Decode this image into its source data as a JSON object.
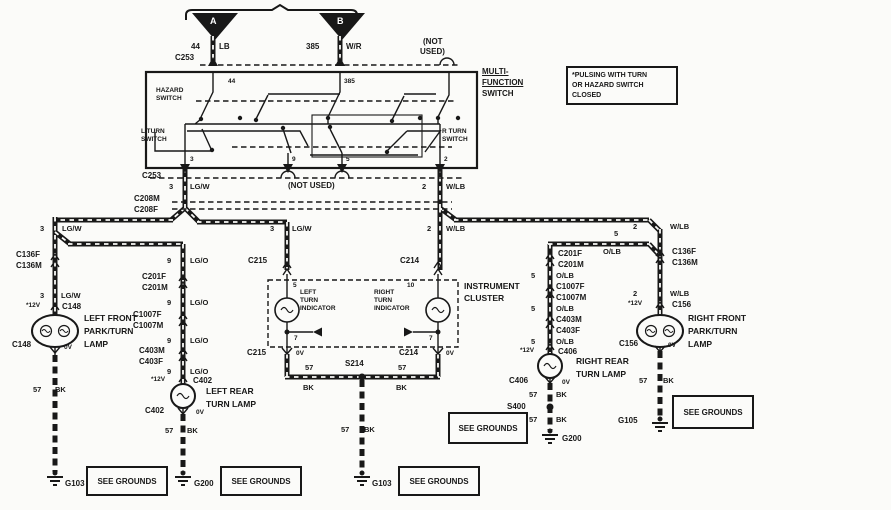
{
  "colors": {
    "ink": "#181818",
    "bg": "#fbfbf9"
  },
  "top": {
    "a": "A",
    "b": "B",
    "circuit_a": "44",
    "color_a": "LB",
    "circuit_b": "385",
    "color_b": "W/R",
    "not_used_1": "(NOT",
    "not_used_2": "USED)",
    "c253": "C253"
  },
  "note": {
    "l1": "*PULSING WITH TURN",
    "l2": "OR HAZARD SWITCH",
    "l3": "CLOSED"
  },
  "mfs": {
    "t1": "MULTI-",
    "t2": "FUNCTION",
    "t3": "SWITCH",
    "pin44": "44",
    "pin385": "385",
    "hz1": "HAZARD",
    "hz2": "SWITCH",
    "lt1": "L TURN",
    "lt2": "SWITCH",
    "rt1": "R TURN",
    "rt2": "SWITCH",
    "p3": "3",
    "p9": "9",
    "p5": "5",
    "p2": "2"
  },
  "c253b": {
    "label": "C253",
    "p3": "3",
    "w3": "LG/W",
    "nu": "(NOT USED)",
    "p2": "2",
    "w2": "W/LB"
  },
  "c208": {
    "m": "C208M",
    "f": "C208F"
  },
  "lf": {
    "p1": "3",
    "w1": "LG/W",
    "c136f": "C136F",
    "c136m": "C136M",
    "p2": "3",
    "w2": "LG/W",
    "v12": "*12V",
    "c148": "C148",
    "n1": "LEFT FRONT",
    "n2": "PARK/TURN",
    "n3": "LAMP",
    "c148b": "C148",
    "v0": "0V",
    "g57": "57",
    "gbk": "BK",
    "gnd": "G103"
  },
  "lr": {
    "p1": "9",
    "w1": "LG/O",
    "c201f": "C201F",
    "c201m": "C201M",
    "p2": "9",
    "w2": "LG/O",
    "c1007f": "C1007F",
    "c1007m": "C1007M",
    "p3": "9",
    "w3": "LG/O",
    "c403m": "C403M",
    "c403f": "C403F",
    "p4": "9",
    "w4": "LG/O",
    "v12": "*12V",
    "c402": "C402",
    "n1": "LEFT REAR",
    "n2": "TURN LAMP",
    "c402b": "C402",
    "v0": "0V",
    "g57": "57",
    "gbk": "BK",
    "gnd": "G200"
  },
  "cl": {
    "p3": "3",
    "w3": "LG/W",
    "p2": "2",
    "w2": "W/LB",
    "c215": "C215",
    "c214": "C214",
    "pin5": "5",
    "pin10": "10",
    "t1": "INSTRUMENT",
    "t2": "CLUSTER",
    "l1": "LEFT",
    "l2": "TURN",
    "l3": "INDICATOR",
    "r1": "RIGHT",
    "r2": "TURN",
    "r3": "INDICATOR",
    "p7l": "7",
    "p7r": "7",
    "c215b": "C215",
    "v0l": "0V",
    "c214b": "C214",
    "v0r": "0V",
    "s57l": "57",
    "sbkl": "BK",
    "s214": "S214",
    "s57r": "57",
    "sbkr": "BK",
    "g57": "57",
    "gbk": "BK",
    "gnd": "G103"
  },
  "rr": {
    "p1": "5",
    "w1": "O/LB",
    "c201f": "C201F",
    "c201m": "C201M",
    "p2": "5",
    "w2": "O/LB",
    "c1007f": "C1007F",
    "c1007m": "C1007M",
    "p3": "5",
    "w3": "O/LB",
    "c403m": "C403M",
    "c403f": "C403F",
    "p4": "5",
    "w4": "O/LB",
    "v12": "*12V",
    "c406": "C406",
    "n1": "RIGHT REAR",
    "n2": "TURN LAMP",
    "c406b": "C406",
    "v0": "0V",
    "g57a": "57",
    "gbka": "BK",
    "s400": "S400",
    "g57b": "57",
    "gbkb": "BK",
    "gnd": "G200"
  },
  "rf": {
    "p1": "2",
    "w1": "W/LB",
    "c136f": "C136F",
    "c136m": "C136M",
    "p2": "2",
    "w2": "W/LB",
    "v12": "*12V",
    "c156": "C156",
    "n1": "RIGHT FRONT",
    "n2": "PARK/TURN",
    "n3": "LAMP",
    "c156b": "C156",
    "v0": "0V",
    "g57": "57",
    "gbk": "BK",
    "gnd": "G105"
  },
  "sg": {
    "label": "SEE GROUNDS"
  }
}
